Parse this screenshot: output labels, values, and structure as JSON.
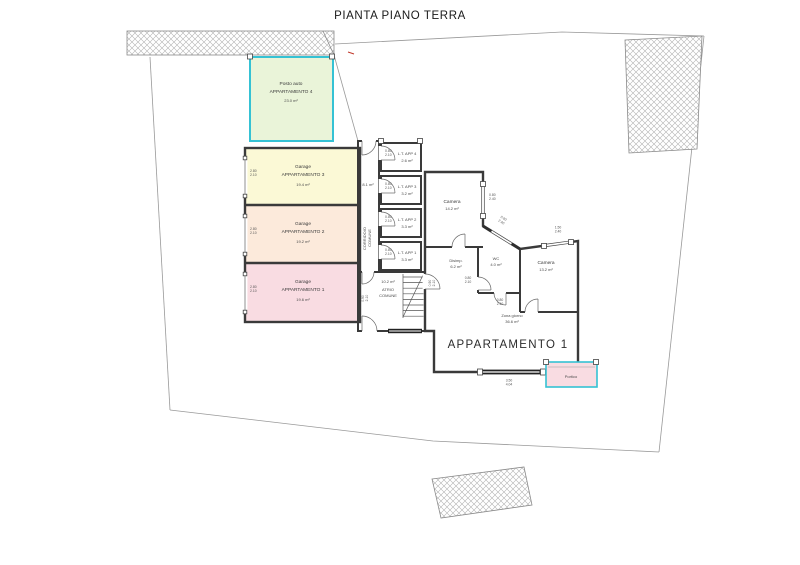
{
  "title": "PIANTA PIANO TERRA",
  "parking": {
    "name": "Posto auto",
    "apt": "APPARTAMENTO 4",
    "area": "23.0 m²"
  },
  "garages": [
    {
      "name": "Garage",
      "apt": "APPARTAMENTO 3",
      "area": "19.4 m²",
      "door_w": "2.80",
      "door_h": "2.10"
    },
    {
      "name": "Garage",
      "apt": "APPARTAMENTO 2",
      "area": "19.2 m²",
      "door_w": "2.80",
      "door_h": "2.10"
    },
    {
      "name": "Garage",
      "apt": "APPARTAMENTO 1",
      "area": "19.6 m²",
      "door_w": "2.80",
      "door_h": "2.10"
    }
  ],
  "storage": [
    {
      "label": "L.T. APP 4",
      "area": "2.6 m²",
      "door_w": "0.80",
      "door_h": "2.10"
    },
    {
      "label": "L.T. APP 3",
      "area": "3.2 m²",
      "door_w": "0.80",
      "door_h": "2.10"
    },
    {
      "label": "L.T. APP 2",
      "area": "3.3 m²",
      "door_w": "0.80",
      "door_h": "2.10"
    },
    {
      "label": "L.T. APP 1",
      "area": "3.3 m²",
      "door_w": "0.80",
      "door_h": "2.10"
    }
  ],
  "common": {
    "corridor_label_1": "CORRIDOIO",
    "corridor_label_2": "COMUNE",
    "corridor_area": "8.1 m²",
    "atrium_area": "10.2 m²",
    "atrium_label_1": "ATRIO",
    "atrium_label_2": "COMUNE"
  },
  "apartment": {
    "label": "APPARTAMENTO 1",
    "camera1": {
      "name": "Camera",
      "area": "14.2 m²"
    },
    "disimp": {
      "name": "Disimp.",
      "area": "6.2 m²"
    },
    "wc": {
      "name": "WC",
      "area": "4.0 m²"
    },
    "camera2": {
      "name": "Camera",
      "area": "13.2 m²"
    },
    "zona_giorno": {
      "name": "Zona giorno",
      "area": "36.6 m²"
    },
    "portico": {
      "name": "Portico"
    }
  },
  "dims": {
    "win_camera1": {
      "w": "0.80",
      "h": "2.40"
    },
    "win_diag": {
      "w": "0.90",
      "h": "2.40"
    },
    "win_camera2": {
      "w": "1.50",
      "h": "2.40"
    },
    "win_zona": {
      "w": "3.50",
      "h": "4.04"
    },
    "door_wc": {
      "w": "0.80",
      "h": "2.10"
    },
    "door_camera2": {
      "w": "0.80",
      "h": "2.10"
    },
    "door_entrance": {
      "w": "0.90",
      "h": "2.10"
    },
    "door_atrium": {
      "w": "0.90",
      "h": "2.10"
    }
  },
  "colors": {
    "wall": "#3a3a3a",
    "cyan_accent": "#35c2d4",
    "parking_green": "#eaf4d9",
    "apt3_yellow": "#fbf9d6",
    "apt2_peach": "#fceadb",
    "apt1_pink": "#f9dce2",
    "common_blue": "#aacdea",
    "storage4_blue": "#c8dff2"
  }
}
